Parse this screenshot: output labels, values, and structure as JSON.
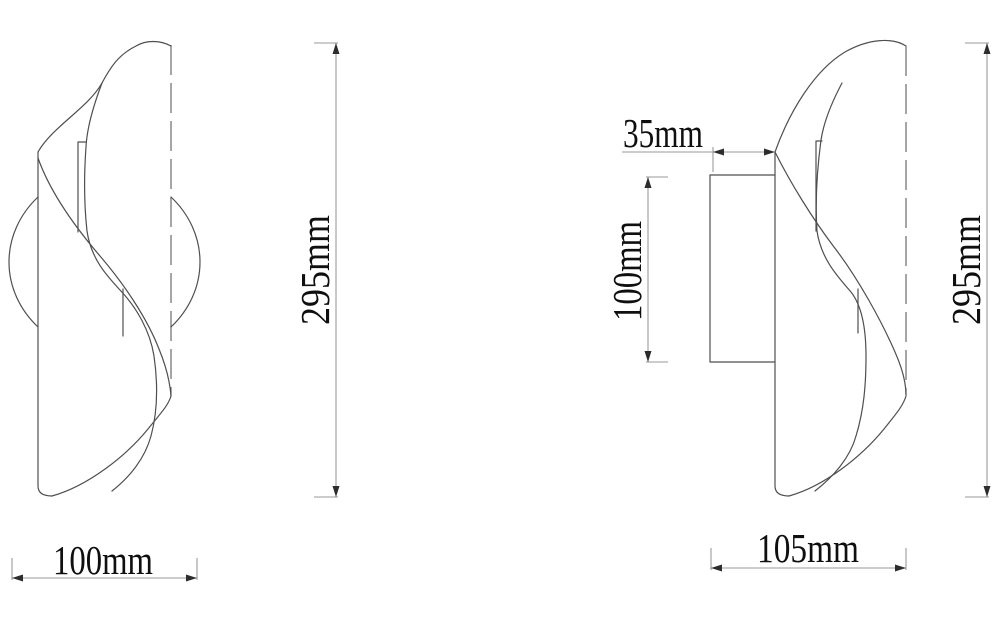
{
  "drawing": {
    "front_view": {
      "name": "wall lamp front view",
      "height_label": "295mm",
      "width_label": "100mm"
    },
    "side_view": {
      "name": "wall lamp side view",
      "mount_depth_label": "35mm",
      "plate_height_label": "100mm",
      "height_label": "295mm",
      "total_depth_label": "105mm"
    },
    "colors": {
      "background": "#ffffff",
      "outline_stroke": "#4f4f4f",
      "dimension_stroke": "#9a9a9a",
      "label_text": "#0f0f0f"
    }
  }
}
